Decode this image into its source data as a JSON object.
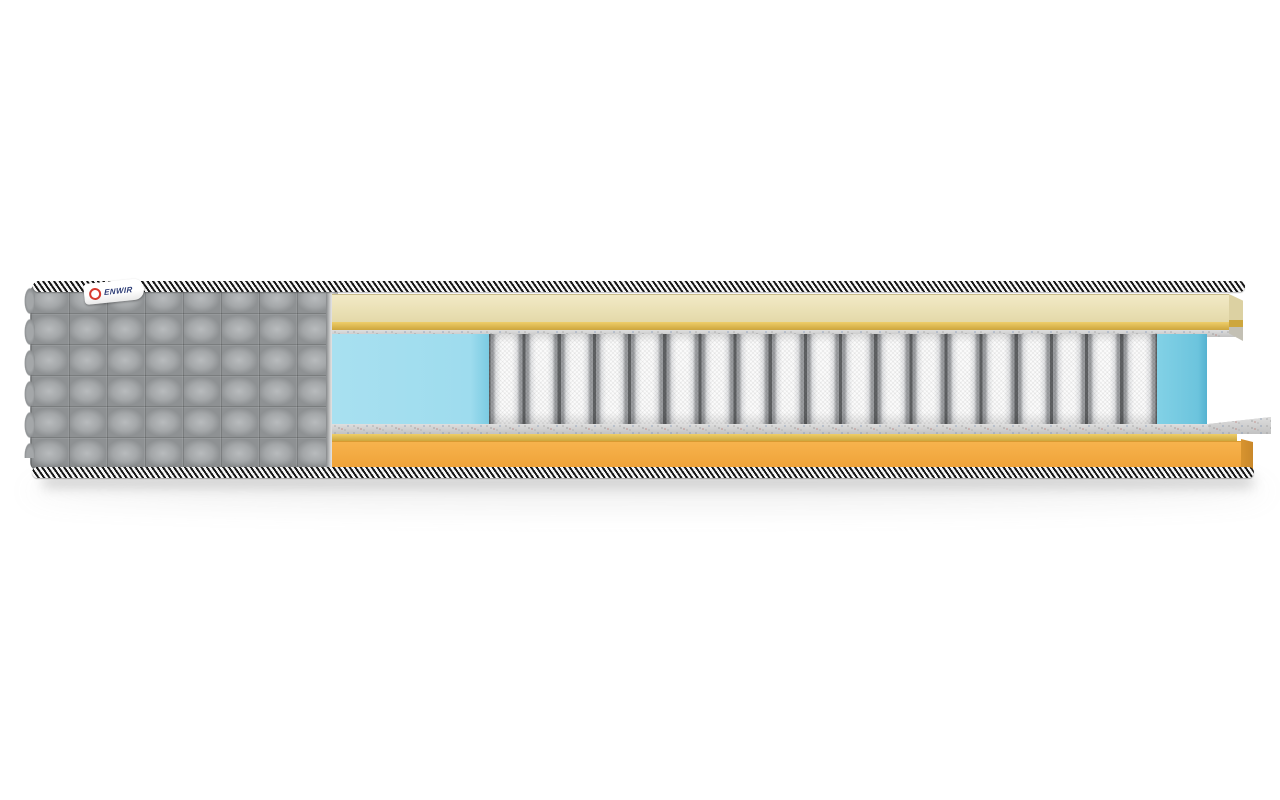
{
  "scene": {
    "type": "product-render",
    "subject": "mattress-cross-section"
  },
  "brand_tag": {
    "text": "ENWIR",
    "logo": "red-ring"
  },
  "springs": {
    "count": 19
  },
  "colors": {
    "page-bg": "#ffffff",
    "quilt-base": "#a4a7a9",
    "quilt-highlight": "#b8bbbd",
    "quilt-shadow": "#8e9193",
    "piping-dark": "#161616",
    "piping-light": "#f7f7f7",
    "cream-top": "#f2eac6",
    "cream-bottom": "#e4d9a9",
    "cream-face": "#dcd1a2",
    "gold-light": "#eece69",
    "gold-dark": "#cda63d",
    "felt-light": "#dedede",
    "felt-dark": "#c2c2c2",
    "blue-cut": "#9edcee",
    "blue-side": "#6cc4dd",
    "spring-light": "#fbfbfb",
    "spring-mid": "#e2e3e5",
    "spring-dark": "#9b9da0",
    "spring-gap": "#606264",
    "orange-top": "#f7b34d",
    "orange-bottom": "#efa238",
    "orange-face": "#d8942f",
    "tag-text": "#2a3a74",
    "tag-logo": "#d63a2f",
    "shadow": "#9a9a9a"
  }
}
